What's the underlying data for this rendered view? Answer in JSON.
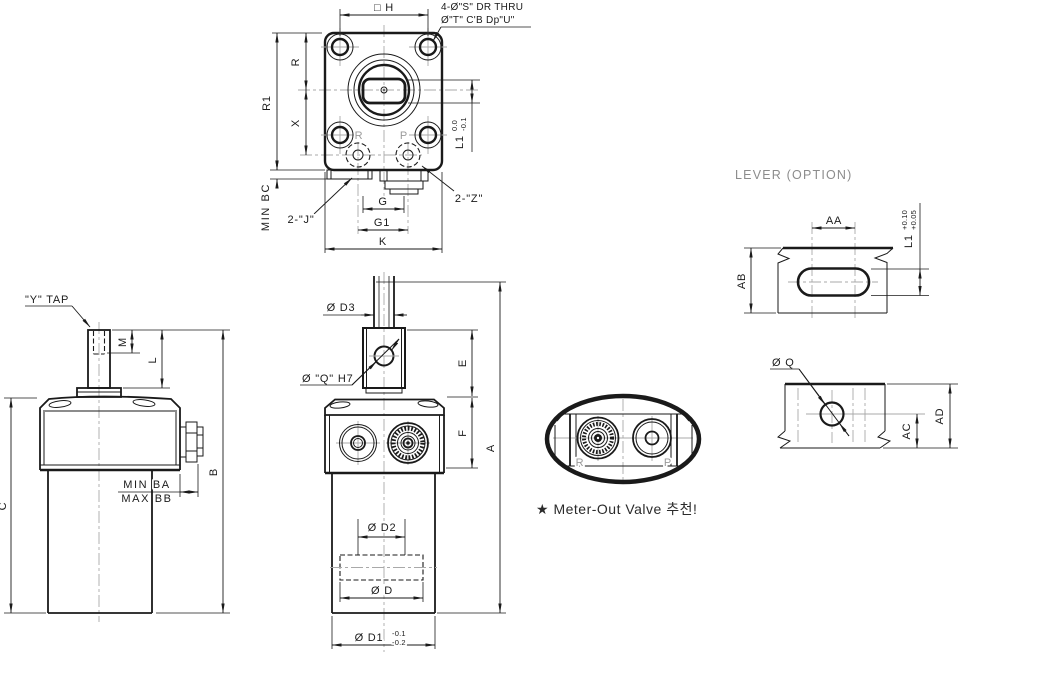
{
  "colors": {
    "line": "#1a1a1a",
    "centerline": "#a9a9a9",
    "muted_text": "#8c8c8c",
    "port_label": "#9a9a9a",
    "background": "#ffffff"
  },
  "views": {
    "top": {
      "h": "□ H",
      "note1": "4-Ø\"S\" DR THRU",
      "note2": "Ø\"T\" C'B Dp\"U\"",
      "r": "R",
      "r1": "R1",
      "x": "X",
      "l1": "L1",
      "l1_tol_upper": "0.0",
      "l1_tol_lower": "-0.1",
      "min_bc": "MIN BC",
      "j": "2-\"J\"",
      "z": "2-\"Z\"",
      "g": "G",
      "g1": "G1",
      "k": "K",
      "port_r": "R",
      "port_p": "P"
    },
    "side": {
      "y_tap": "\"Y\" TAP",
      "m": "M",
      "l": "L",
      "b": "B",
      "c": "C",
      "min_ba": "MIN BA",
      "max_bb": "MAX BB"
    },
    "front": {
      "d3": "Ø D3",
      "q": "Ø \"Q\" H7",
      "e": "E",
      "f": "F",
      "a": "A",
      "d2": "Ø D2",
      "d": "Ø D",
      "d1": "Ø D1",
      "d1_tol_upper": "-0.1",
      "d1_tol_lower": "-0.2"
    },
    "detail": {
      "port_r": "R",
      "port_p": "P",
      "note": "★ Meter-Out Valve 추천!"
    },
    "lever": {
      "title": "LEVER (OPTION)",
      "aa": "AA",
      "ab": "AB",
      "l1": "L1",
      "l1_tol_upper": "+0.10",
      "l1_tol_lower": "+0.05",
      "q": "Ø Q",
      "ac": "AC",
      "ad": "AD"
    }
  }
}
